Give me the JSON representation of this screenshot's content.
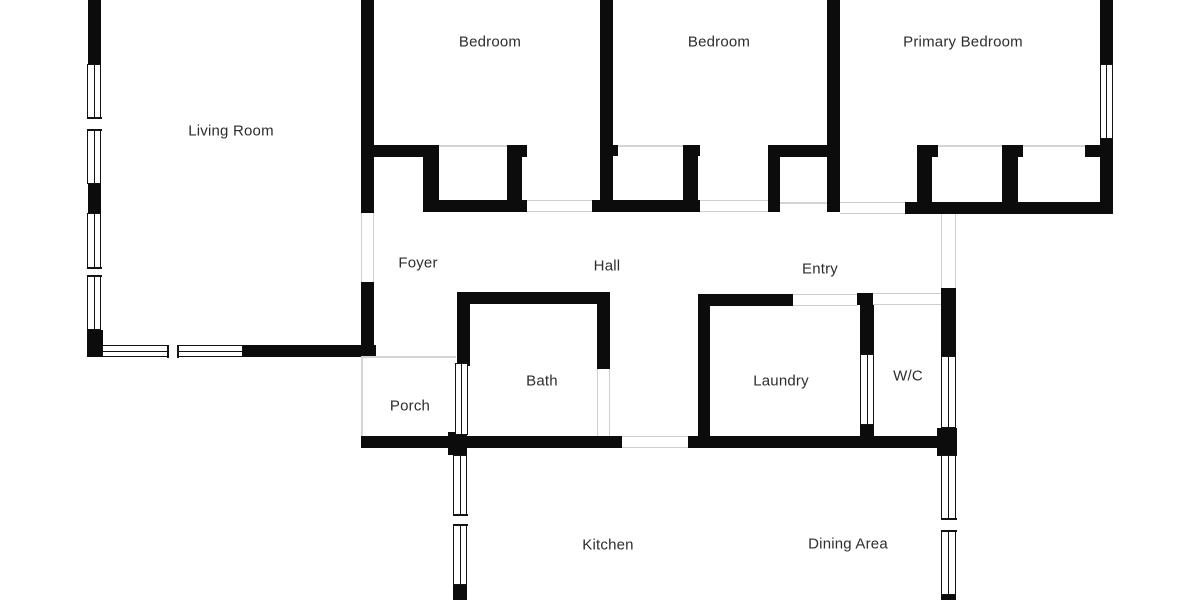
{
  "plan": {
    "type": "floor-plan"
  },
  "rooms": [
    {
      "id": "living-room",
      "label": "Living Room"
    },
    {
      "id": "bedroom-1",
      "label": "Bedroom"
    },
    {
      "id": "bedroom-2",
      "label": "Bedroom"
    },
    {
      "id": "primary-bedroom",
      "label": "Primary Bedroom"
    },
    {
      "id": "foyer",
      "label": "Foyer"
    },
    {
      "id": "hall",
      "label": "Hall"
    },
    {
      "id": "entry",
      "label": "Entry"
    },
    {
      "id": "porch",
      "label": "Porch"
    },
    {
      "id": "bath",
      "label": "Bath"
    },
    {
      "id": "laundry",
      "label": "Laundry"
    },
    {
      "id": "wc",
      "label": "W/C"
    },
    {
      "id": "kitchen",
      "label": "Kitchen"
    },
    {
      "id": "dining-area",
      "label": "Dining Area"
    }
  ],
  "colors": {
    "wall": "#0c0c0c",
    "window_outline": "#141414",
    "opening_line": "#cfcfcf",
    "label_text": "#2d2d2d",
    "background": "#ffffff"
  }
}
